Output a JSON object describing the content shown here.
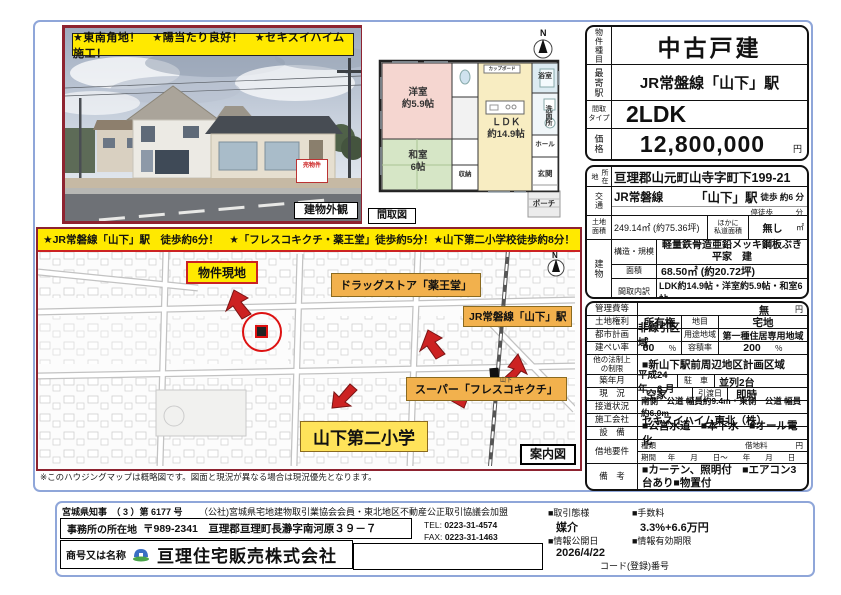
{
  "photo": {
    "banner": "★東南角地！　★陽当たり良好！　★セキスイハイム施工！",
    "caption": "建物外観",
    "sign_text": "売物件"
  },
  "floorplan": {
    "caption": "間取図",
    "north_label": "N",
    "rooms": {
      "western": "洋室\n約5.9帖",
      "japanese": "和室\n6帖",
      "ldk": "ＬＤＫ\n約14.9帖",
      "bath": "浴室",
      "washroom": "洗面所",
      "hall": "ホール",
      "entrance": "玄関",
      "porch": "ポーチ",
      "closet": "収納",
      "cupboard": "カップボード"
    }
  },
  "map": {
    "banner": "★JR常磐線「山下」駅　徒歩約6分！　★「フレスコキクチ・薬王堂」徒歩約5分！★山下第二小学校徒歩約8分！",
    "north_label": "N",
    "site_label": "物件現地",
    "drug_label": "ドラッグストア「薬王堂」",
    "station_label": "JR常磐線「山下」駅",
    "super_label": "スーパー「フレスコキクチ」",
    "school_label": "山下第二小学",
    "station_name": "山下",
    "corner_label": "案内図",
    "note": "※このハウジングマップは概略図です。図面と現況が異なる場合は現況優先となります。"
  },
  "summary": {
    "type_label": "物件種目",
    "type_value": "中古戸建",
    "station_label": "最寄駅",
    "station_value": "JR常盤線「山下」駅",
    "madori_label": "間取\nタイプ",
    "madori_value": "2LDK",
    "price_label": "価格",
    "price_value": "12,800,000",
    "price_unit": "円"
  },
  "location": {
    "addr_label": "所在地",
    "addr_value": "亘理郡山元町山寺字町下199-21",
    "access_label": "交通",
    "access_line": "JR常磐線",
    "access_station": "「山下」駅",
    "access_walk": "徒歩 約6 分",
    "access_sub": "停徒歩　　　分",
    "land_label": "土地\n面積",
    "land_value": "249.14㎡ (約75.36坪)",
    "land_other_label": "ほかに\n私道面積",
    "land_other_value": "無し",
    "land_unit": "㎡",
    "bldg_label": "建物",
    "structure_label": "構造・規模",
    "structure_value": "軽量鉄骨造亜鉛メッキ鋼板ぶき\n平家　建",
    "area_label": "面積",
    "area_value": "68.50㎡ (約20.72坪)",
    "rooms_label": "間取内訳",
    "rooms_value": "LDK約14.9帖・洋室約5.9帖・和室6帖"
  },
  "details": {
    "kanri_label": "管理費等",
    "kanri_value": "無",
    "kanri_unit": "円",
    "kenri_label": "土地権利",
    "kenri_value": "所有権",
    "chimoku_label": "地目",
    "chimoku_value": "宅地",
    "toshi_label": "都市計画",
    "toshi_value": "非線引区域",
    "yoto_label": "用途地域",
    "yoto_value": "第一種住居専用地域",
    "kenpei_label": "建ぺい率",
    "kenpei_value": "60",
    "kenpei_unit": "％",
    "yoseki_label": "容積率",
    "yoseki_value": "200",
    "yoseki_unit": "％",
    "hoka_label": "他の法制上\nの制限",
    "hoka_value": "■新山下駅前周辺地区計画区域",
    "chikunen_label": "築年月",
    "chikunen_value": "平成24 年　6 月",
    "parking_label": "駐　車",
    "parking_value": "並列2台",
    "genkyo_label": "現　況",
    "genkyo_value": "空家",
    "hikiwatashi_label": "引渡日",
    "hikiwatashi_value": "即時",
    "setsudou_label": "接道状況",
    "setsudou_value": "南側　公道 幅員約9.4m・東側　公道 幅員約6.0m",
    "sekou_label": "施工会社",
    "sekou_value": "セキスイハイム東北（株）",
    "setsubi_label": "設　備",
    "setsubi_value": "■公営水道　■本下水　■オール電化",
    "shakuchi_label": "借地要件",
    "shurui_label": "種類",
    "chidai_label": "借地料",
    "chidai_unit": "円",
    "kikan_label": "期間",
    "kikan_value": "年　　月　　日～　　年　　月　　日",
    "biko_label": "備　考",
    "biko_value": "■カーテン、照明付　■エアコン3台あり■物置付"
  },
  "footer": {
    "license_left": "宮城県知事　（ 3 ）第 6177 号",
    "license_right": "（公社)宮城県宅地建物取引業協会会員・東北地区不動産公正取引協議会加盟",
    "office_label": "事務所の所在地",
    "office_value": "〒989-2341　亘理郡亘理町長瀞字南河原３９－７",
    "tel_label": "TEL:",
    "tel_value": "0223-31-4574",
    "fax_label": "FAX:",
    "fax_value": "0223-31-1463",
    "name_label": "商号又は名称",
    "name_value": "亘理住宅販売株式会社",
    "mode_label": "■取引態様",
    "mode_value": "媒介",
    "fee_label": "■手数料",
    "fee_value": "3.3%+6.6万円",
    "open_label": "■情報公開日",
    "open_value": "2026/4/22",
    "valid_label": "■情報有効期限",
    "code_label": "コード(登録)番号"
  }
}
